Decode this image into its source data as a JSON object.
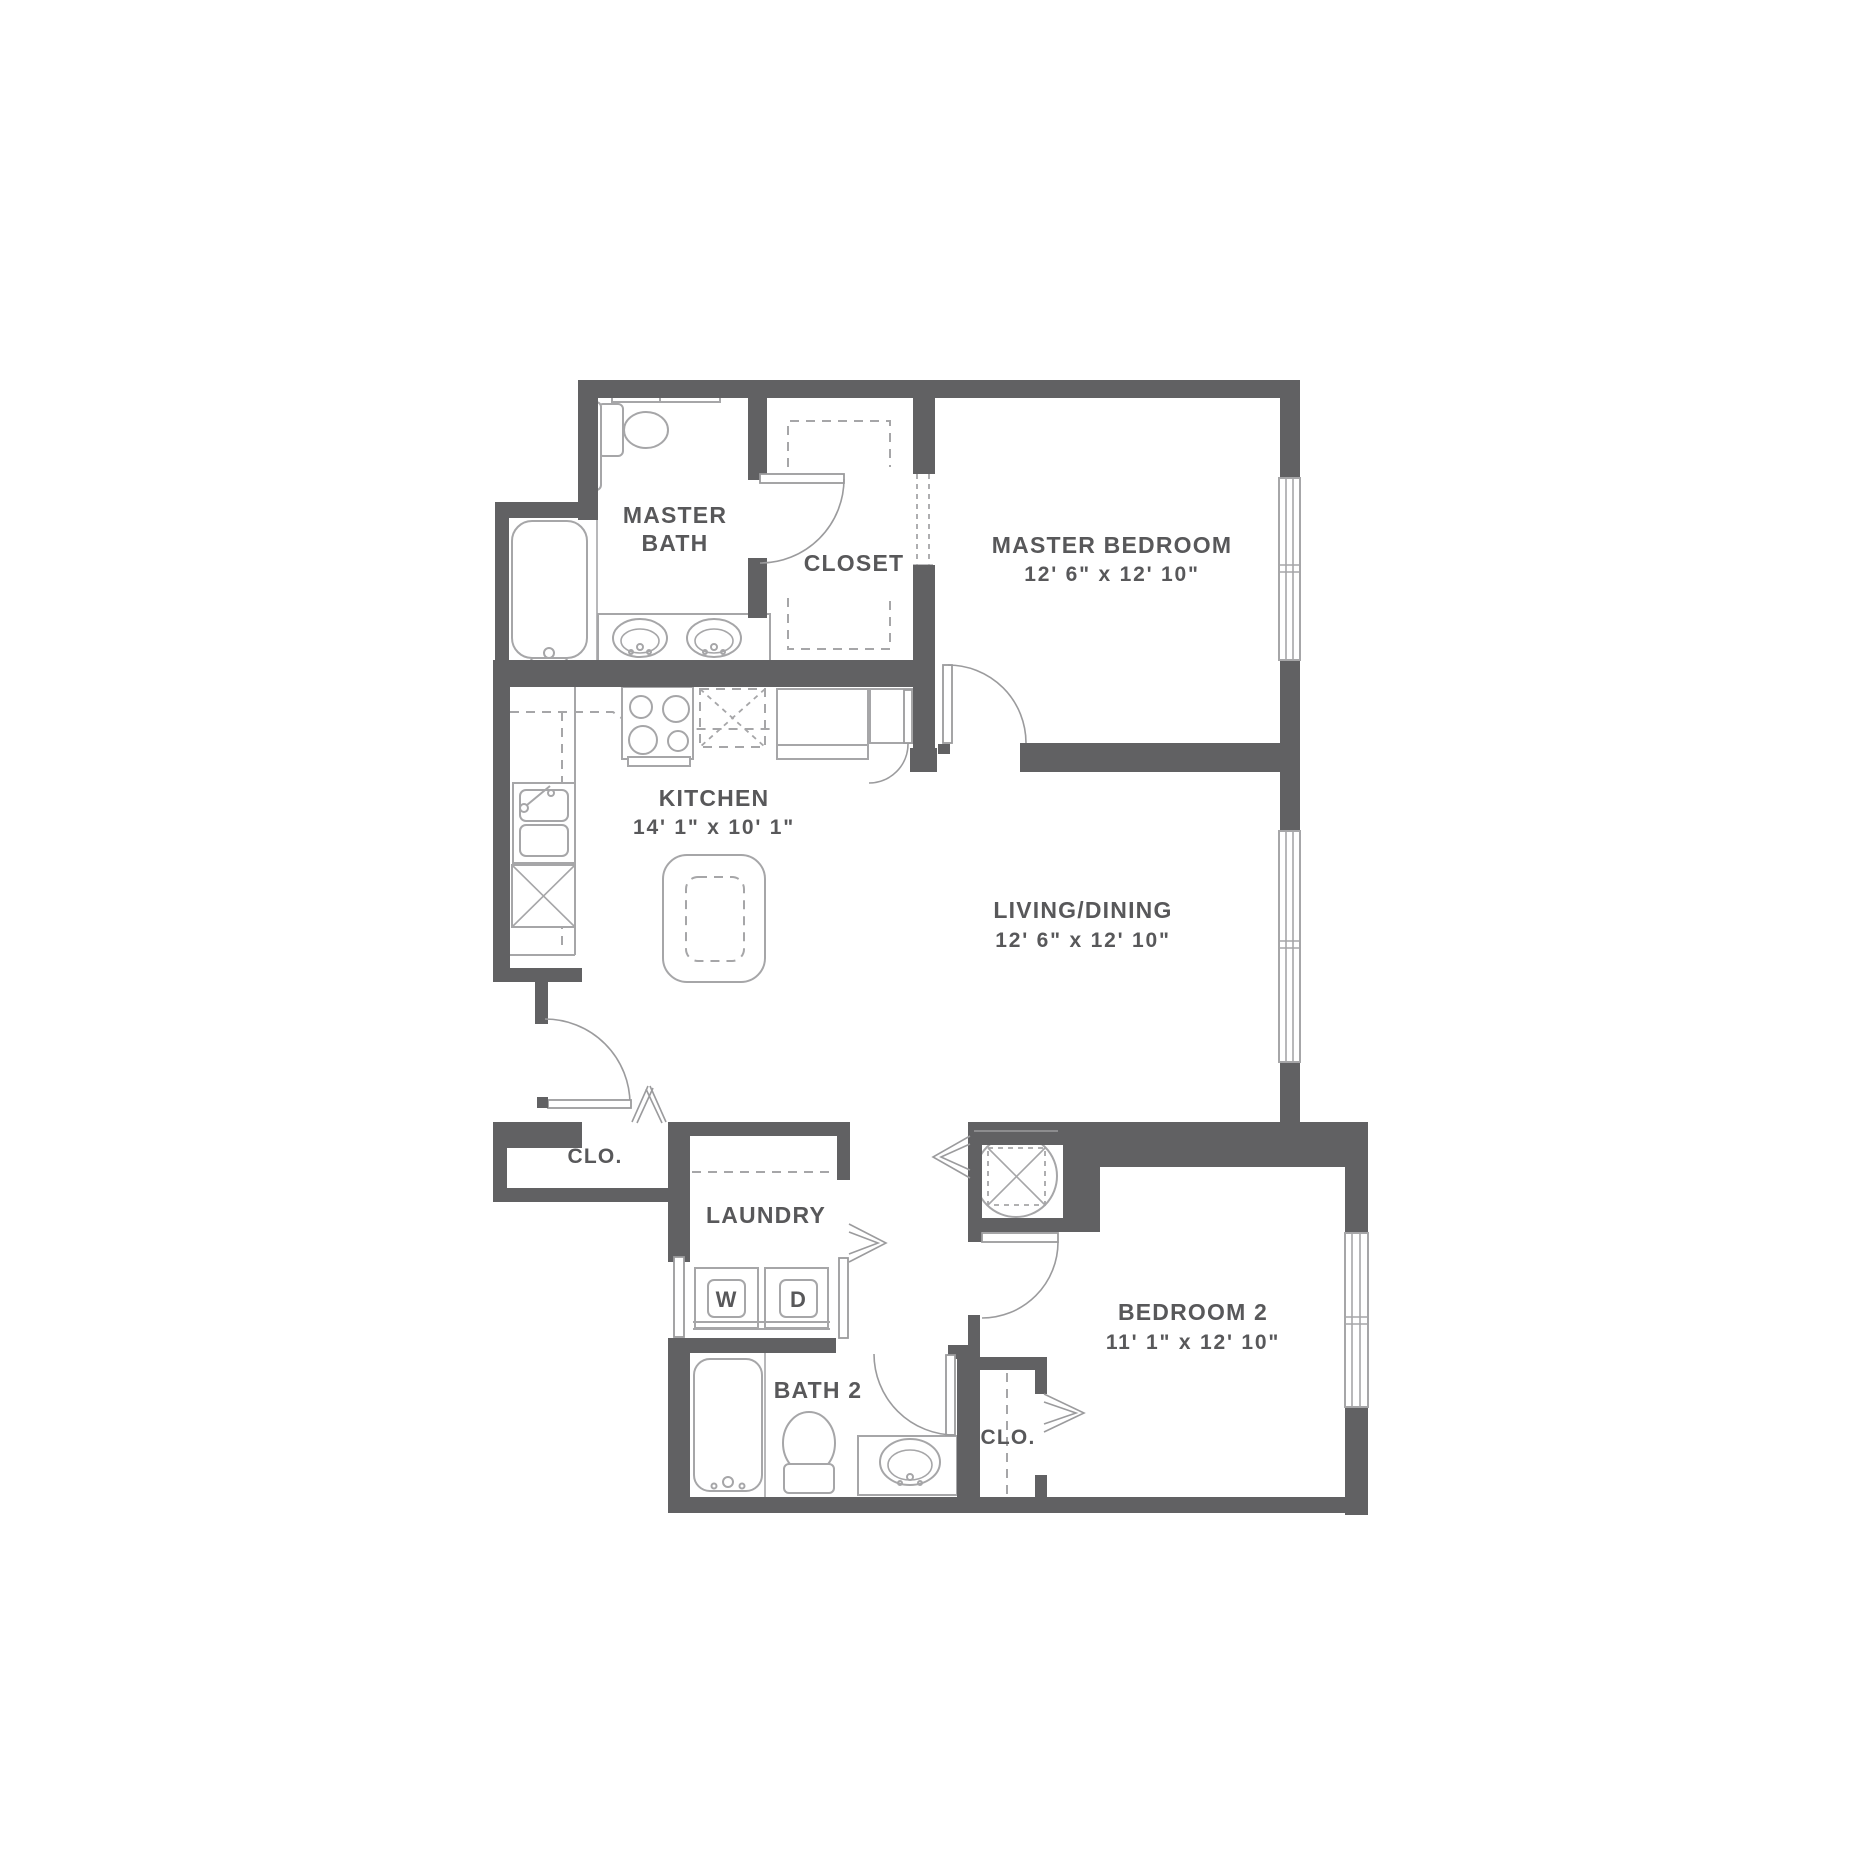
{
  "page": {
    "type": "apartment floor plan",
    "background": "#ffffff"
  },
  "palette": {
    "wall": "#616163",
    "fixture_line": "#a6a6a8",
    "door_line": "#9b9b9d",
    "label_text": "#58585a"
  },
  "rooms": {
    "master_bath": {
      "name_line1": "MASTER",
      "name_line2": "BATH"
    },
    "closet": {
      "name": "CLOSET"
    },
    "master_bedroom": {
      "name": "MASTER BEDROOM",
      "dims": "12' 6\" x 12' 10\""
    },
    "kitchen": {
      "name": "KITCHEN",
      "dims": "14' 1\" x 10' 1\""
    },
    "living_dining": {
      "name": "LIVING/DINING",
      "dims": "12' 6\" x 12' 10\""
    },
    "entry_closet": {
      "name": "CLO."
    },
    "laundry": {
      "name": "LAUNDRY",
      "washer_label": "W",
      "dryer_label": "D"
    },
    "bath_2": {
      "name": "BATH 2"
    },
    "bedroom_2": {
      "name": "BEDROOM 2",
      "dims": "11' 1\" x 12' 10\"",
      "closet_name": "CLO."
    }
  }
}
